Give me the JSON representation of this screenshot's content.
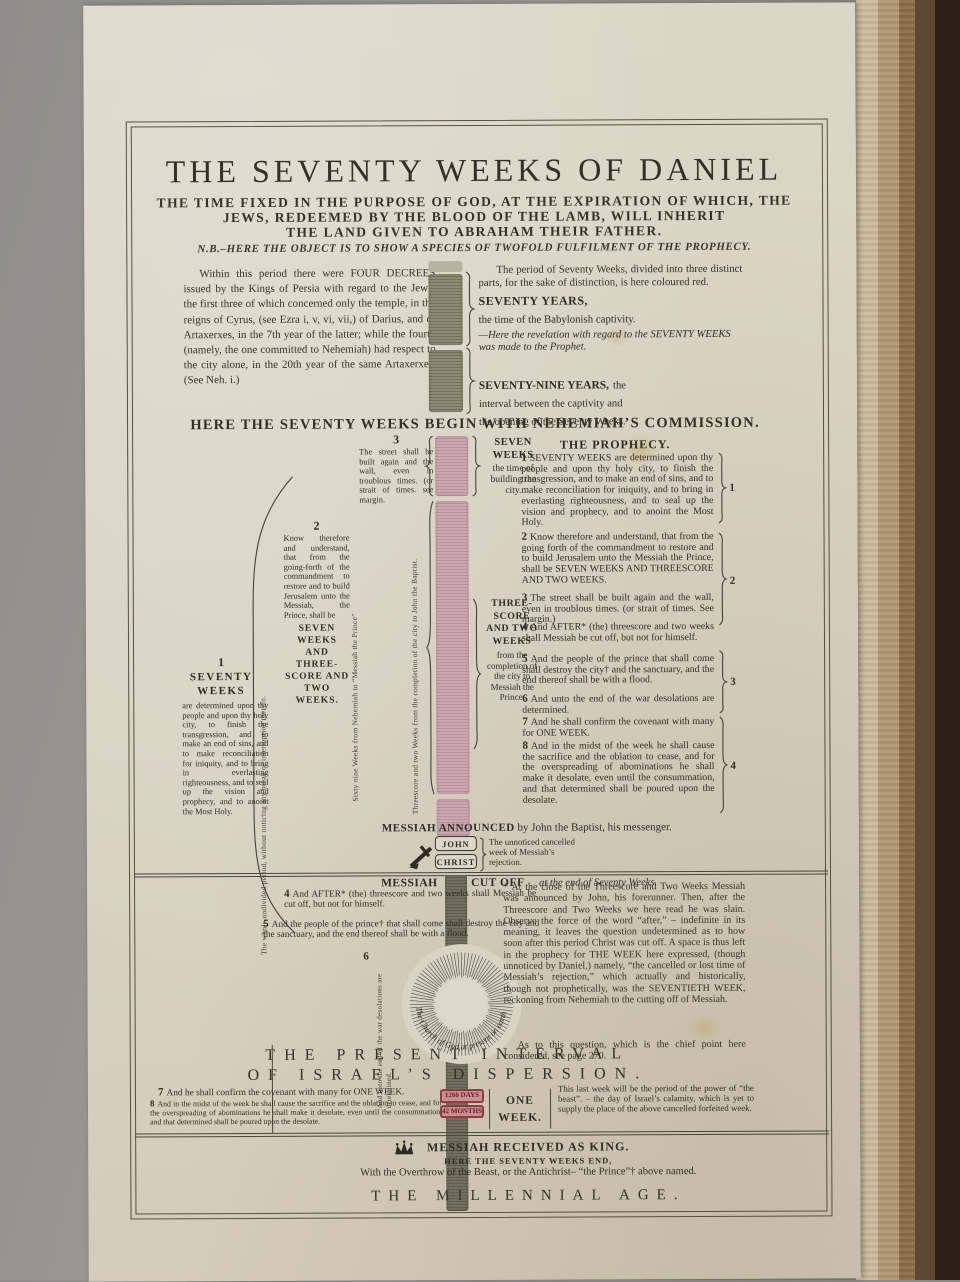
{
  "header": {
    "title": "THE SEVENTY WEEKS OF DANIEL",
    "subtitle1": "THE TIME FIXED IN THE PURPOSE OF GOD, AT THE EXPIRATION OF WHICH, THE",
    "subtitle2": "JEWS, REDEEMED BY THE BLOOD OF THE LAMB, WILL INHERIT",
    "subtitle3": "THE LAND GIVEN TO ABRAHAM THEIR FATHER.",
    "nb": "N.B.–HERE THE OBJECT IS TO SHOW A SPECIES OF TWOFOLD FULFILMENT OF THE PROPHECY."
  },
  "intro": {
    "left_paragraph": "Within this period there were FOUR DECREES issued by the Kings of Persia with regard to the Jews; the first three of which concerned only the temple, in the reigns of Cyrus, (see Ezra i, v, vi, vii,) of Darius, and of Artaxerxes, in the 7th year of the latter; while the fourth (namely, the one committed to Nehemiah) had respect to the city alone, in the 20th year of the same Artaxerxes. (See Neh. i.)",
    "right_intro": "The period of Seventy Weeks, divided into three distinct parts, for the sake of distinction, is here coloured red.",
    "seventy_years_title": "SEVENTY YEARS,",
    "seventy_years_body": "the time of the Babylonish captivity.",
    "revelation": "—Here the revelation with regard to the SEVENTY WEEKS was made to the Prophet.",
    "seventy_nine_title": "SEVENTY-NINE YEARS,",
    "seventy_nine_body": "the interval between the captivity and the opening of the Seventy Weeks."
  },
  "commission": "HERE THE SEVENTY WEEKS BEGIN WITH NEHEMIAH’S COMMISSION.",
  "timeline": {
    "col1_num": "1",
    "col1_title": "SEVENTY WEEKS",
    "col1_body": "are determined upon thy people and upon thy holy city, to finish the transgression, and to make an end of sins, and to make reconciliation for iniquity, and to bring in everlasting righteousness, and to seal up the vision and prophecy, and to anoint the Most Holy.",
    "col2_num": "2",
    "col2_body": "Know therefore and understand, that from the going-forth of the commandment to restore and to build Jerusalem unto the Messiah, the Prince, shall be",
    "col2_emph": "SEVEN WEEKS AND THREE-SCORE AND TWO WEEKS.",
    "col3_num": "3",
    "col3_body": "The street shall be built again and the wall, even in troublous times. (or strait of times. see margin.",
    "rot_whole_period": "The whole undivided period, without noticing any break or interruption therein.",
    "rot_sixty_nine": "Sixty nine Weeks from Nehemiah to “Messiah the Prince”",
    "rot_threescore": "Threescore and two Weeks from the completion of the city to John the Baptist.",
    "seven_weeks_label": "SEVEN WEEKS",
    "seven_weeks_sub": "the time of building the city.",
    "threescore_label": "THREE-SCORE AND TWO WEEKS",
    "threescore_sub": "from the completion of the city to Messiah the Prince."
  },
  "prophecy": {
    "heading": "THE PROPHECY.",
    "items": [
      {
        "num": "1",
        "text": "SEVENTY WEEKS are determined upon thy people and upon thy holy city, to finish the transgression, and to make an end of sins, and to make reconciliation for iniquity, and to bring in everlasting righteousness, and to seal up the vision and prophecy, and to anoint the Most Holy."
      },
      {
        "num": "2",
        "text": "Know therefore and understand, that from the going forth of the commandment to restore and to build Jerusalem unto the Messiah the Prince, shall be SEVEN WEEKS AND THREESCORE AND TWO WEEKS."
      },
      {
        "num": "3",
        "text": "The street shall be built again and the wall, even in troublous times. (or strait of times. See margin.)"
      },
      {
        "num": "4",
        "text": "And AFTER* (the) threescore and two weeks shall Messiah be cut off, but not for himself."
      },
      {
        "num": "5",
        "text": "And the people of the prince that shall come shall destroy the city† and the sanctuary, and the end thereof shall be with a flood."
      },
      {
        "num": "6",
        "text": "And unto the end of the war desolations are determined."
      },
      {
        "num": "7",
        "text": "And he shall confirm the covenant with many for ONE WEEK."
      },
      {
        "num": "8",
        "text": "And in the midst of the week he shall cause the sacrifice and the oblation to cease, and for the overspreading of abominations he shall make it desolate, even until the consummation, and that determined shall be poured upon the desolate."
      }
    ],
    "brace_marks": [
      "1",
      "2",
      "3",
      "4"
    ]
  },
  "announced": {
    "bold": "MESSIAH ANNOUNCED",
    "rest": "by John the Baptist, his messenger.",
    "box1": "JOHN",
    "box2": "CHRIST",
    "note": "The unnoticed cancelled week of Messiah’s rejection."
  },
  "cutoff": {
    "heading_bold1": "MESSIAH",
    "heading_bold2": "CUT OFF",
    "heading_italic": "at the end of Seventy Weeks",
    "item4_num": "4",
    "item4": "And AFTER* (the) threescore and two weeks shall Messiah be cut off, but not for himself.",
    "item5_num": "5",
    "item5": "And the people of the prince† that shall come shall destroy the city and the sanctuary, and the end thereof shall be with a flood.",
    "item6_num": "6",
    "item6_rot": "And unto the end of the war desolations are determined.",
    "circle_text": "The Church of God at present on earth",
    "footnote": "* At the close of the Threescore and Two Weeks Messiah was announced by John, his forerunner. Then, after the Threescore and Two Weeks we here read he was slain. Observe the force of the word “after,” – indefinite in its meaning, it leaves the question undetermined as to how soon after this period Christ was cut off. A space is thus left in the prophecy for THE WEEK here expressed, (though unnoticed by Daniel,) namely, “the cancelled or lost time of Messiah’s rejection,” which actually and historically, though not prophetically, was the SEVENTIETH WEEK, reckoning from Nehemiah to the cutting off of Messiah.",
    "footnote2": "As to this question, which is the chief point here considered, see page 270."
  },
  "interval": {
    "line1": "THE PRESENT INTERVAL",
    "line2": "OF ISRAEL’S DISPERSION."
  },
  "final_week": {
    "item7_num": "7",
    "item7": "And he shall confirm the covenant with many for ONE WEEK.",
    "item8_num": "8",
    "item8": "And in the midst of the week he shall cause the sacrifice and the oblation to cease, and for the overspreading of abominations he shall make it desolate, even until the consummation, and that determined shall be poured upon the desolate.",
    "badge_days": "1260 DAYS",
    "badge_months": "42 MONTHS",
    "one_week1": "ONE",
    "one_week2": "WEEK.",
    "right_note": "This last week will be the period of the power of “the beast”. – the day of Israel’s calamity, which is yet to supply the place of the above cancelled forfeited week."
  },
  "king": {
    "line1": "MESSIAH RECEIVED AS KING.",
    "line2": "HERE THE SEVENTY WEEKS END,",
    "line3": "With the Overthrow of the Beast, or the Antichrist– “the Prince”† above named.",
    "millennial": "THE MILLENNIAL AGE."
  },
  "colors": {
    "paper": "#d9d3c3",
    "red_bar": "#c7a4ab",
    "gray_bar": "#87856f",
    "dark_bar": "#6e6c5e",
    "badge_red": "#b24e52",
    "ink": "#2f2d26"
  }
}
